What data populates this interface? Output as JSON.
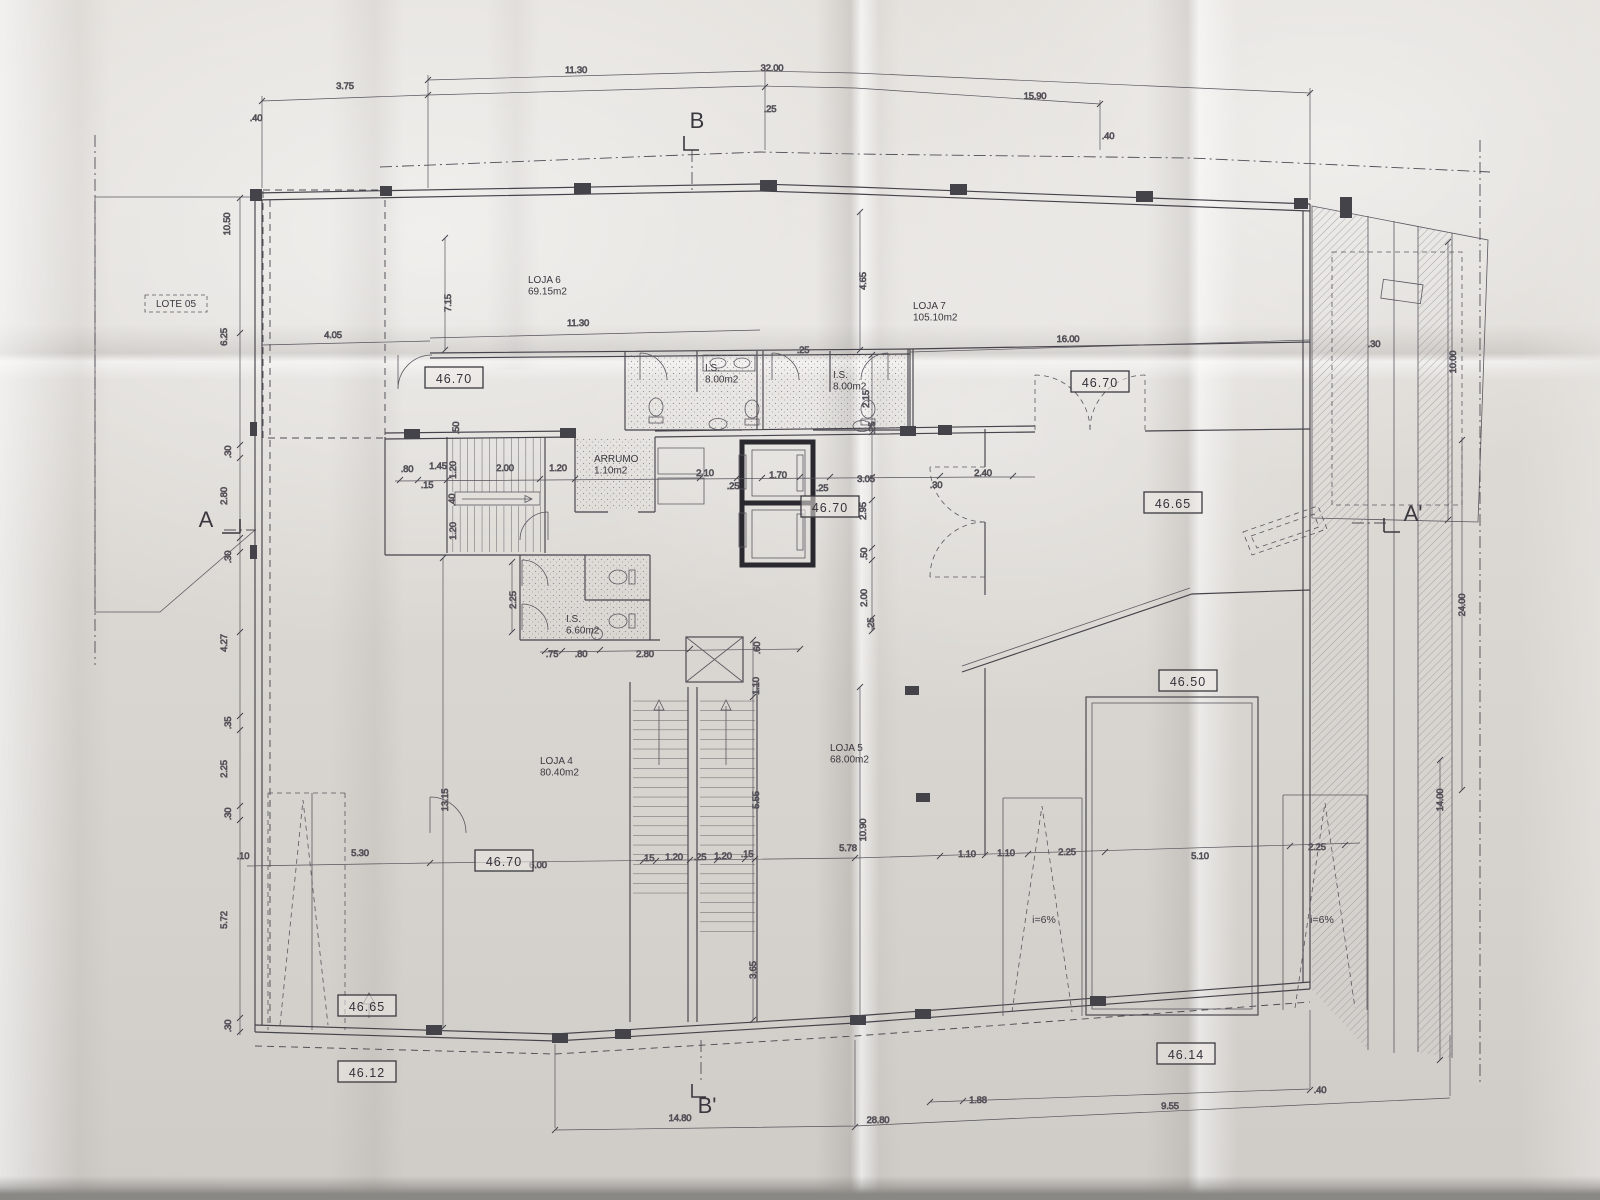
{
  "drawing": {
    "kind": "architectural floor plan photo (folded paper print)",
    "colors": {
      "paper": "#dcd9d4",
      "ink": "#45434b",
      "heavy_wall": "#2a2930",
      "hatch": "#918e95"
    }
  },
  "annotations": {
    "rooms": [
      {
        "id": "loja-6",
        "name": "LOJA 6",
        "area": "69.15m2",
        "x": 528,
        "y": 283
      },
      {
        "id": "loja-7",
        "name": "LOJA 7",
        "area": "105.10m2",
        "x": 913,
        "y": 309
      },
      {
        "id": "loja-4",
        "name": "LOJA 4",
        "area": "80.40m2",
        "x": 540,
        "y": 764
      },
      {
        "id": "loja-5",
        "name": "LOJA 5",
        "area": "68.00m2",
        "x": 830,
        "y": 751
      },
      {
        "id": "is-loja6",
        "name": "I.S.",
        "area": "8.00m2",
        "x": 705,
        "y": 371
      },
      {
        "id": "is-loja7",
        "name": "I.S.",
        "area": "8.00m2",
        "x": 833,
        "y": 378
      },
      {
        "id": "is-660",
        "name": "I.S.",
        "area": "6.60m2",
        "x": 566,
        "y": 622
      },
      {
        "id": "arrumo",
        "name": "ARRUMO",
        "area": "1.10m2",
        "x": 594,
        "y": 462,
        "size": 8.5
      },
      {
        "id": "lote-05",
        "name": "LOTE 05",
        "area": "",
        "x": 176,
        "y": 307,
        "boxed": true,
        "size": 9
      }
    ],
    "elevations": [
      {
        "value": "46.70",
        "x": 454,
        "y": 379
      },
      {
        "value": "46.70",
        "x": 1100,
        "y": 383
      },
      {
        "value": "46.70",
        "x": 830,
        "y": 508
      },
      {
        "value": "46.70",
        "x": 504,
        "y": 862
      },
      {
        "value": "46.65",
        "x": 1173,
        "y": 504
      },
      {
        "value": "46.65",
        "x": 367,
        "y": 1007
      },
      {
        "value": "46.50",
        "x": 1188,
        "y": 682
      },
      {
        "value": "46.12",
        "x": 367,
        "y": 1073
      },
      {
        "value": "46.14",
        "x": 1186,
        "y": 1055
      }
    ],
    "sections": [
      {
        "label": "B",
        "x": 697,
        "y": 128
      },
      {
        "label": "B'",
        "x": 707,
        "y": 1113
      },
      {
        "label": "A",
        "x": 206,
        "y": 527
      },
      {
        "label": "A'",
        "x": 1413,
        "y": 521
      }
    ],
    "slopes": [
      {
        "label": "i=6%",
        "x": 1044,
        "y": 923
      },
      {
        "label": "i=6%",
        "x": 1322,
        "y": 923
      }
    ],
    "dimensions": [
      {
        "t": ".40",
        "x": 256,
        "y": 121
      },
      {
        "t": "3.75",
        "x": 345,
        "y": 89
      },
      {
        "t": "11.30",
        "x": 576,
        "y": 73
      },
      {
        "t": "32.00",
        "x": 772,
        "y": 71
      },
      {
        "t": ".25",
        "x": 770,
        "y": 112
      },
      {
        "t": "15.90",
        "x": 1035,
        "y": 99
      },
      {
        "t": ".40",
        "x": 1108,
        "y": 139
      },
      {
        "t": "11.30",
        "x": 578,
        "y": 326
      },
      {
        "t": "16.00",
        "x": 1068,
        "y": 342
      },
      {
        "t": "4.65",
        "x": 866,
        "y": 281,
        "r": 1
      },
      {
        "t": "7.15",
        "x": 451,
        "y": 303,
        "r": 1
      },
      {
        "t": "4.05",
        "x": 333,
        "y": 338
      },
      {
        "t": "10.50",
        "x": 230,
        "y": 224,
        "r": 1
      },
      {
        "t": "6.25",
        "x": 227,
        "y": 337,
        "r": 1
      },
      {
        "t": ".30",
        "x": 231,
        "y": 452,
        "r": 1
      },
      {
        "t": "2.80",
        "x": 227,
        "y": 496,
        "r": 1
      },
      {
        "t": ".30",
        "x": 231,
        "y": 557,
        "r": 1
      },
      {
        "t": "4.27",
        "x": 227,
        "y": 643,
        "r": 1
      },
      {
        "t": ".35",
        "x": 231,
        "y": 723,
        "r": 1
      },
      {
        "t": "2.25",
        "x": 227,
        "y": 769,
        "r": 1
      },
      {
        "t": ".30",
        "x": 231,
        "y": 814,
        "r": 1
      },
      {
        "t": "5.72",
        "x": 227,
        "y": 920,
        "r": 1
      },
      {
        "t": ".30",
        "x": 231,
        "y": 1026,
        "r": 1
      },
      {
        "t": ".80",
        "x": 407,
        "y": 472
      },
      {
        "t": "1.45",
        "x": 438,
        "y": 469
      },
      {
        "t": ".15",
        "x": 427,
        "y": 488
      },
      {
        "t": "2.00",
        "x": 505,
        "y": 471
      },
      {
        "t": "1.20",
        "x": 558,
        "y": 471
      },
      {
        "t": ".50",
        "x": 459,
        "y": 428,
        "r": 1
      },
      {
        "t": "1.20",
        "x": 456,
        "y": 470,
        "r": 1
      },
      {
        "t": ".40",
        "x": 455,
        "y": 500,
        "r": 1
      },
      {
        "t": "1.20",
        "x": 456,
        "y": 531,
        "r": 1
      },
      {
        "t": "2.10",
        "x": 705,
        "y": 476
      },
      {
        "t": ".25",
        "x": 733,
        "y": 489
      },
      {
        "t": "1.70",
        "x": 778,
        "y": 478
      },
      {
        "t": ".25",
        "x": 822,
        "y": 491
      },
      {
        "t": "3.05",
        "x": 866,
        "y": 482
      },
      {
        "t": ".30",
        "x": 936,
        "y": 488
      },
      {
        "t": "2.40",
        "x": 983,
        "y": 476
      },
      {
        "t": "2.95",
        "x": 866,
        "y": 511,
        "r": 1
      },
      {
        "t": ".50",
        "x": 867,
        "y": 554,
        "r": 1
      },
      {
        "t": "2.00",
        "x": 867,
        "y": 598,
        "r": 1
      },
      {
        "t": ".25",
        "x": 874,
        "y": 624,
        "r": 1
      },
      {
        "t": "2.15",
        "x": 869,
        "y": 399,
        "r": 1
      },
      {
        "t": ".25",
        "x": 803,
        "y": 353
      },
      {
        "t": ".25",
        "x": 875,
        "y": 428,
        "r": 1
      },
      {
        "t": "2.25",
        "x": 516,
        "y": 600,
        "r": 1
      },
      {
        "t": ".75",
        "x": 552,
        "y": 657
      },
      {
        "t": ".80",
        "x": 581,
        "y": 657
      },
      {
        "t": "2.80",
        "x": 645,
        "y": 657
      },
      {
        "t": ".60",
        "x": 760,
        "y": 648,
        "r": 1
      },
      {
        "t": "1.10",
        "x": 759,
        "y": 686,
        "r": 1
      },
      {
        "t": "5.55",
        "x": 759,
        "y": 800,
        "r": 1
      },
      {
        "t": "3.65",
        "x": 756,
        "y": 970,
        "r": 1
      },
      {
        "t": "10.90",
        "x": 866,
        "y": 830,
        "r": 1
      },
      {
        "t": "13.15",
        "x": 448,
        "y": 800,
        "r": 1
      },
      {
        "t": ".10",
        "x": 243,
        "y": 859
      },
      {
        "t": "5.30",
        "x": 360,
        "y": 856
      },
      {
        "t": "6.00",
        "x": 538,
        "y": 868
      },
      {
        "t": ".15",
        "x": 648,
        "y": 861
      },
      {
        "t": "1.20",
        "x": 674,
        "y": 860
      },
      {
        "t": ".25",
        "x": 700,
        "y": 860
      },
      {
        "t": "1.20",
        "x": 723,
        "y": 859
      },
      {
        "t": ".15",
        "x": 747,
        "y": 857
      },
      {
        "t": "5.78",
        "x": 848,
        "y": 851
      },
      {
        "t": "1.10",
        "x": 967,
        "y": 857
      },
      {
        "t": "1.10",
        "x": 1006,
        "y": 856
      },
      {
        "t": "2.25",
        "x": 1067,
        "y": 855
      },
      {
        "t": "5.10",
        "x": 1200,
        "y": 859
      },
      {
        "t": "2.25",
        "x": 1317,
        "y": 850
      },
      {
        "t": "14.80",
        "x": 680,
        "y": 1121
      },
      {
        "t": "28.80",
        "x": 878,
        "y": 1123
      },
      {
        "t": "1.88",
        "x": 978,
        "y": 1103
      },
      {
        "t": "9.55",
        "x": 1170,
        "y": 1109
      },
      {
        "t": ".40",
        "x": 1320,
        "y": 1093
      },
      {
        "t": ".30",
        "x": 1374,
        "y": 347
      },
      {
        "t": "10.00",
        "x": 1456,
        "y": 362,
        "r": 1
      },
      {
        "t": "24.00",
        "x": 1465,
        "y": 605,
        "r": 1
      },
      {
        "t": "14.00",
        "x": 1443,
        "y": 800,
        "r": 1
      }
    ]
  }
}
